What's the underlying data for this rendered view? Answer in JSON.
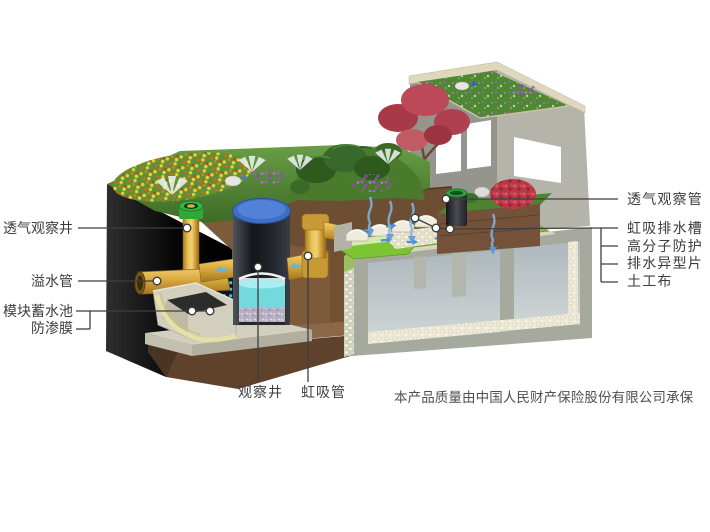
{
  "labels": {
    "left": [
      {
        "id": "vent-observation-well",
        "text": "透气观察井"
      },
      {
        "id": "overflow-pipe",
        "text": "溢水管"
      },
      {
        "id": "module-storage-tank",
        "text": "模块蓄水池"
      },
      {
        "id": "impermeable-membrane",
        "text": "防渗膜"
      }
    ],
    "right": [
      {
        "id": "vent-observation-pipe",
        "text": "透气观察管"
      },
      {
        "id": "siphon-drainage-channel",
        "text": "虹吸排水槽"
      },
      {
        "id": "polymer-protection",
        "text": "高分子防护"
      },
      {
        "id": "drainage-profiled-sheet",
        "text": "排水异型片"
      },
      {
        "id": "geotextile",
        "text": "土工布"
      }
    ],
    "bottom": [
      {
        "id": "observation-well",
        "text": "观察井"
      },
      {
        "id": "siphon-pipe",
        "text": "虹吸管"
      }
    ]
  },
  "footnote": {
    "text": "本产品质量由中国人民财产保险股份有限公司承保"
  },
  "colors": {
    "label_text": "#3d3d3d",
    "leader_line": "#3f3f3f",
    "pipe_yellow": "#d9ab42",
    "pipe_cap_green": "#2fa838",
    "well_cap_blue": "#4273cc",
    "water_cyan": "#74d9dc",
    "module_dot_blue": "#3cc2ea",
    "protection_green": "#7cc433",
    "grass_green": "#4e7e2c",
    "soil_brown": "#6e4e32",
    "concrete_gray": "#c9c5b6",
    "flow_arrow_blue": "#4a90d8"
  }
}
